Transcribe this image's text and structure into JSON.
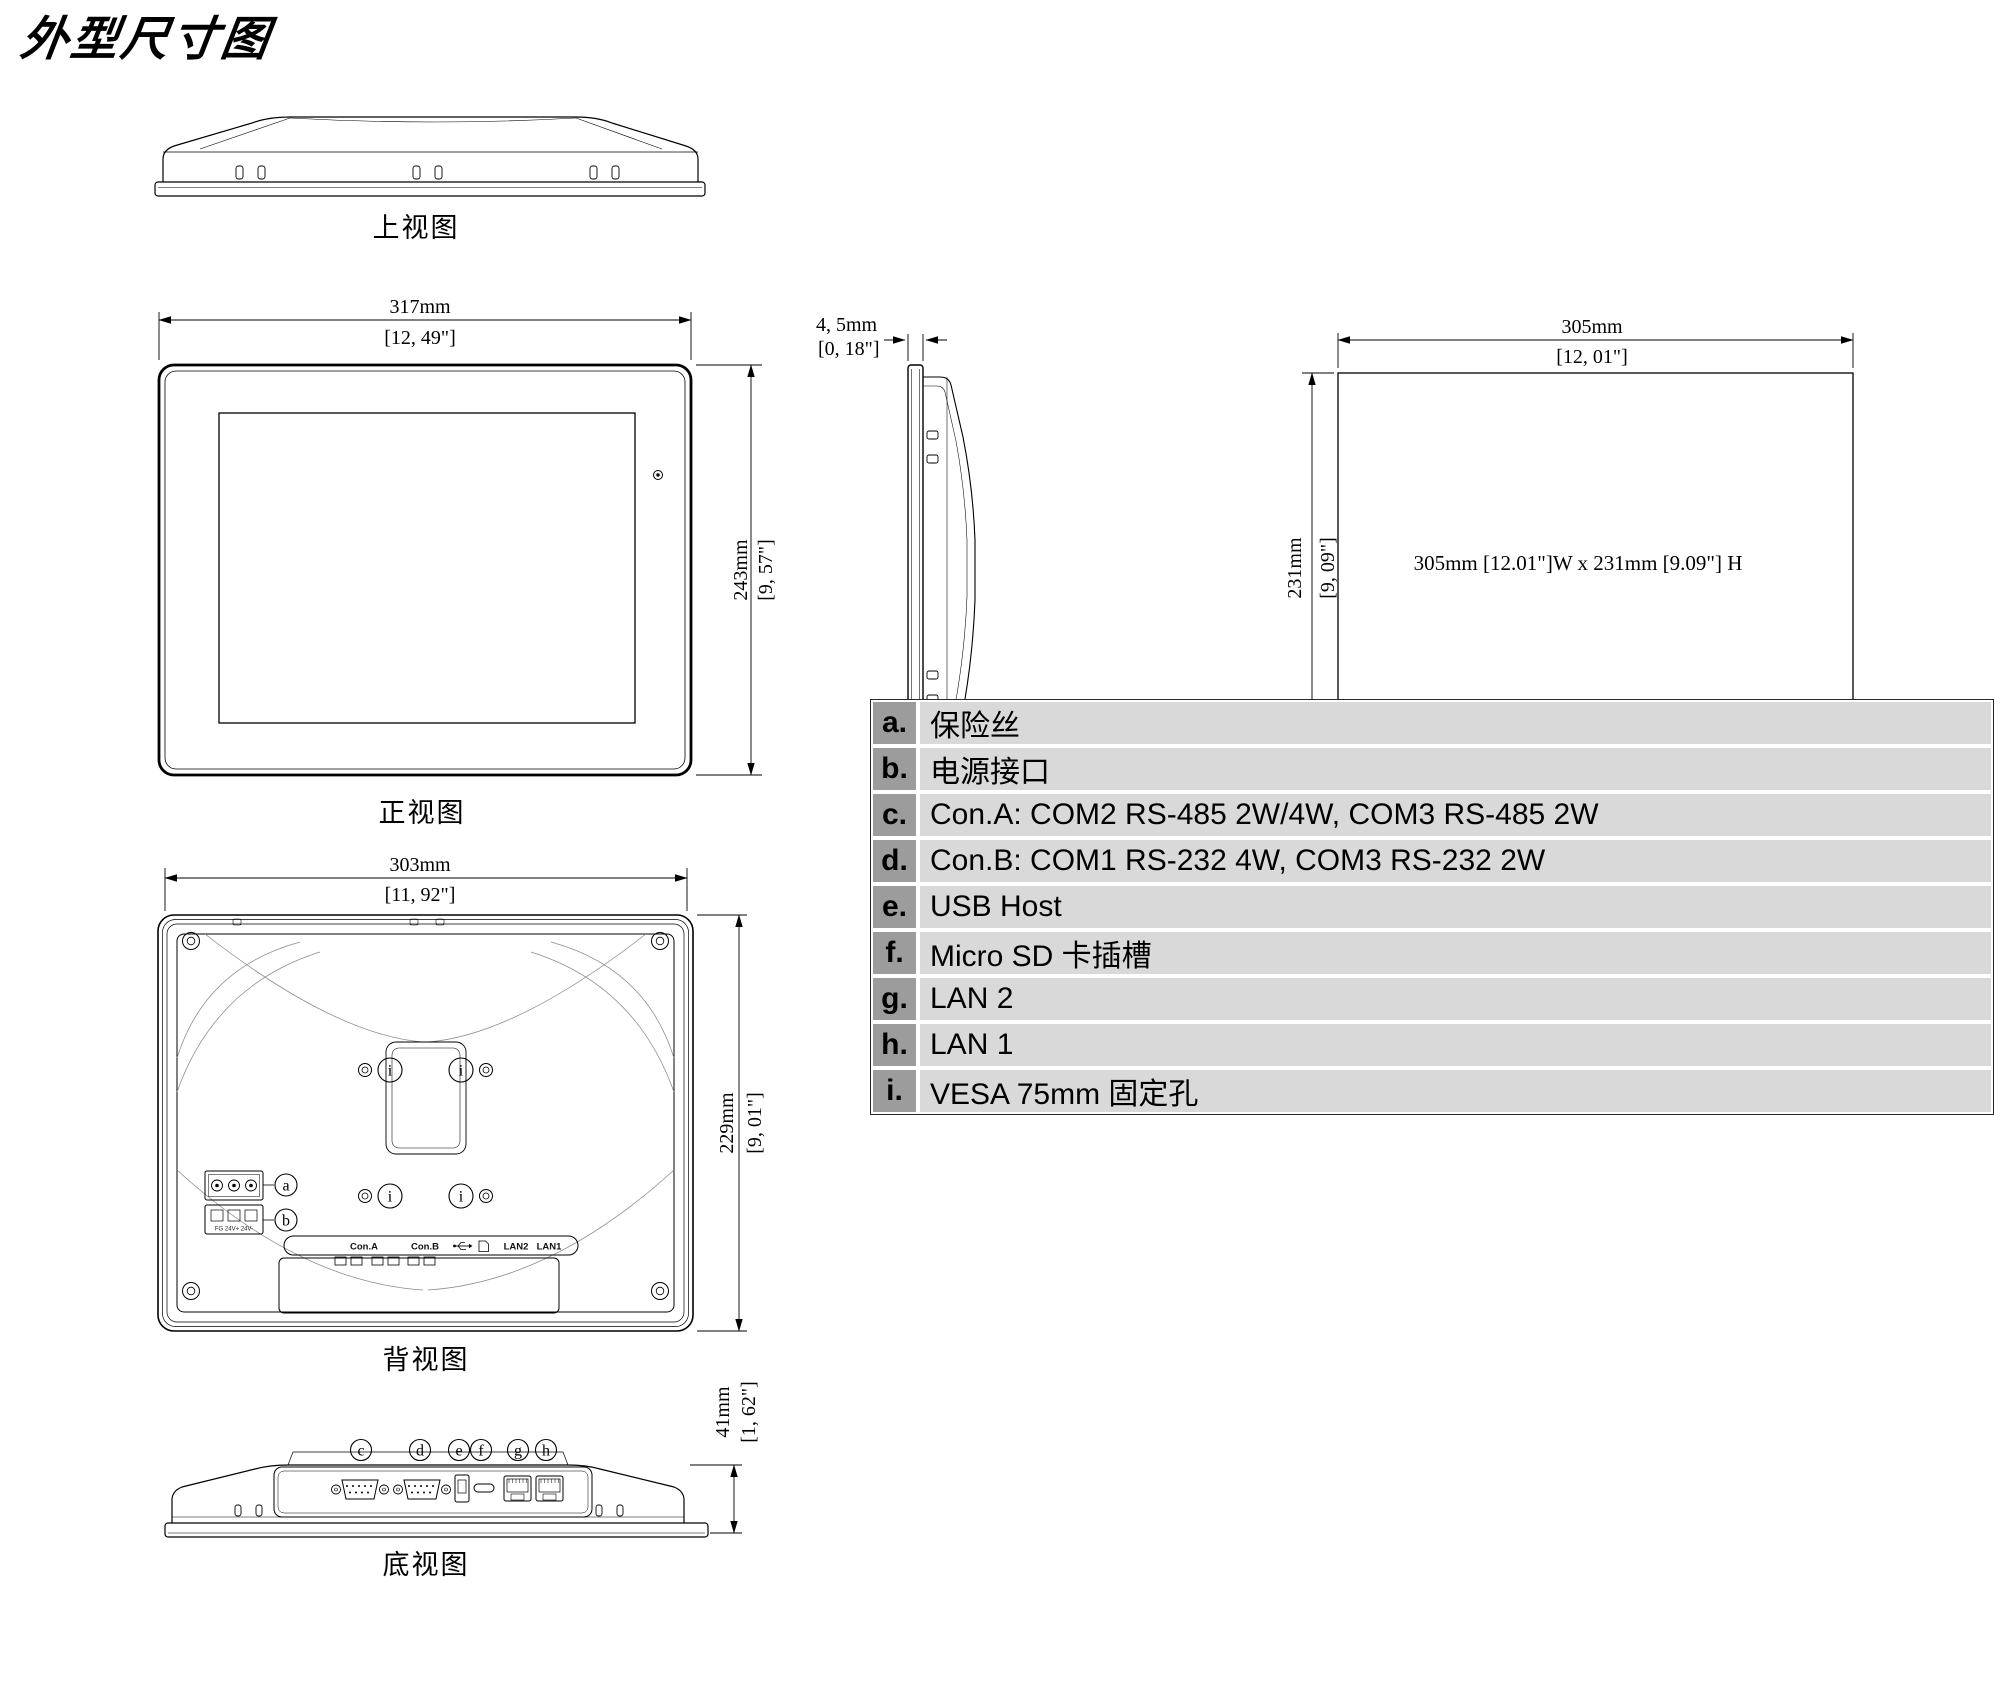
{
  "title": "外型尺寸图",
  "views": {
    "top": {
      "label": "上视图"
    },
    "front": {
      "label": "正视图",
      "width_mm": "317mm",
      "width_in": "[12, 49\"]",
      "height_mm": "243mm",
      "height_in": "[9, 57\"]"
    },
    "side": {
      "label": "侧视图",
      "thickness_mm": "4, 5mm",
      "thickness_in": "[0, 18\"]"
    },
    "cutout": {
      "label": "开孔尺寸图",
      "width_mm": "305mm",
      "width_in": "[12, 01\"]",
      "height_mm": "231mm",
      "height_in": "[9, 09\"]",
      "note": "305mm [12.01\"]W x 231mm [9.09\"] H"
    },
    "rear": {
      "label": "背视图",
      "width_mm": "303mm",
      "width_in": "[11, 92\"]",
      "height_mm": "229mm",
      "height_in": "[9, 01\"]",
      "ports": {
        "con_a": "Con.A",
        "con_b": "Con.B",
        "lan2": "LAN2",
        "lan1": "LAN1"
      },
      "power_marking": "FG 24V+ 24V-"
    },
    "bottom": {
      "label": "底视图",
      "depth_mm": "41mm",
      "depth_in": "[1, 62\"]"
    }
  },
  "callouts": {
    "a": "a",
    "b": "b",
    "c": "c",
    "d": "d",
    "e": "e",
    "f": "f",
    "g": "g",
    "h": "h",
    "i": "i"
  },
  "legend": {
    "rows": [
      {
        "key": "a.",
        "desc": "保险丝"
      },
      {
        "key": "b.",
        "desc": "电源接口"
      },
      {
        "key": "c.",
        "desc": "Con.A: COM2 RS-485 2W/4W, COM3 RS-485 2W"
      },
      {
        "key": "d.",
        "desc": "Con.B: COM1 RS-232 4W, COM3 RS-232 2W"
      },
      {
        "key": "e.",
        "desc": "USB Host"
      },
      {
        "key": "f.",
        "desc": "Micro SD 卡插槽"
      },
      {
        "key": "g.",
        "desc": "LAN 2"
      },
      {
        "key": "h.",
        "desc": "LAN 1"
      },
      {
        "key": "i.",
        "desc": "VESA 75mm 固定孔"
      }
    ]
  }
}
